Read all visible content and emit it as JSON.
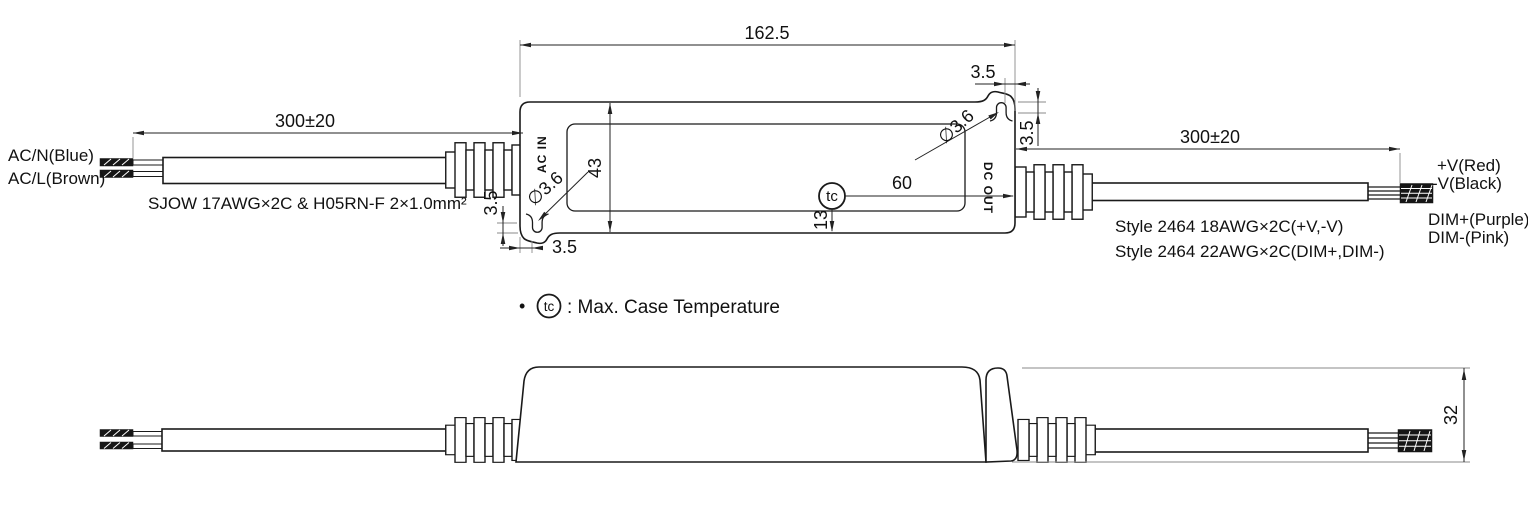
{
  "labels": {
    "acn": "AC/N(Blue)",
    "acl": "AC/L(Brown)",
    "input_cable": "SJOW 17AWG×2C & H05RN-F 2×1.0mm²",
    "output_cable_1": "Style 2464 18AWG×2C(+V,-V)",
    "output_cable_2": "Style 2464 22AWG×2C(DIM+,DIM-)",
    "vplus": "+V(Red)",
    "vminus": "-V(Black)",
    "dimplus": "DIM+(Purple)",
    "dimminus": "DIM-(Pink)",
    "ac_in": "AC IN",
    "dc_out": "DC OUT",
    "tc": "tc"
  },
  "dims": {
    "body_length": "162.5",
    "input_cable_length": "300±20",
    "output_cable_length": "300±20",
    "body_width": "43",
    "tc_offset_x": "60",
    "tc_offset_y": "13",
    "ear_left_v": "3.5",
    "ear_left_h": "3.5",
    "ear_right_h": "3.5",
    "ear_right_v": "3.5",
    "hole_left": "∅3.6",
    "hole_right": "∅3.6",
    "case_height": "32"
  },
  "note": {
    "bullet": "•",
    "tc": "tc",
    "text": ": Max. Case Temperature"
  }
}
